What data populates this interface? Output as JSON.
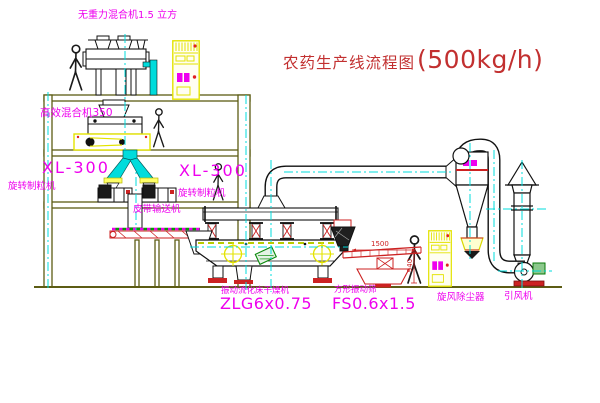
{
  "title": {
    "name": "农药生产线流程图",
    "capacity": "(500kg/h)"
  },
  "labels": {
    "gravity_mixer": "无重力混合机1.5 立方",
    "high_eff_mixer": "高效混合机350",
    "granulator_model_left": "XL-300",
    "granulator_name_left": "旋转制粒机",
    "granulator_model_right": "XL-300",
    "granulator_name_right": "旋转制粒机",
    "belt_conveyor": "皮带输送机",
    "dryer_name": "振动流化床干燥机",
    "dryer_model": "ZLG6x0.75",
    "screen_name": "方形振动筛",
    "screen_model": "FS0.6x1.5",
    "cyclone": "旋风除尘器",
    "fan": "引风机"
  },
  "dimensions": {
    "screen_width": "1500",
    "screen_height": "940"
  },
  "colors": {
    "label_magenta": "#ee00ee",
    "title_red": "#c23030",
    "accent_red": "#cc2222",
    "centerline_cyan": "#00dcdc",
    "cabinet_yellow": "#e3e300",
    "structure_olive": "#5c5c14",
    "motor_green": "#0a8a0a"
  }
}
